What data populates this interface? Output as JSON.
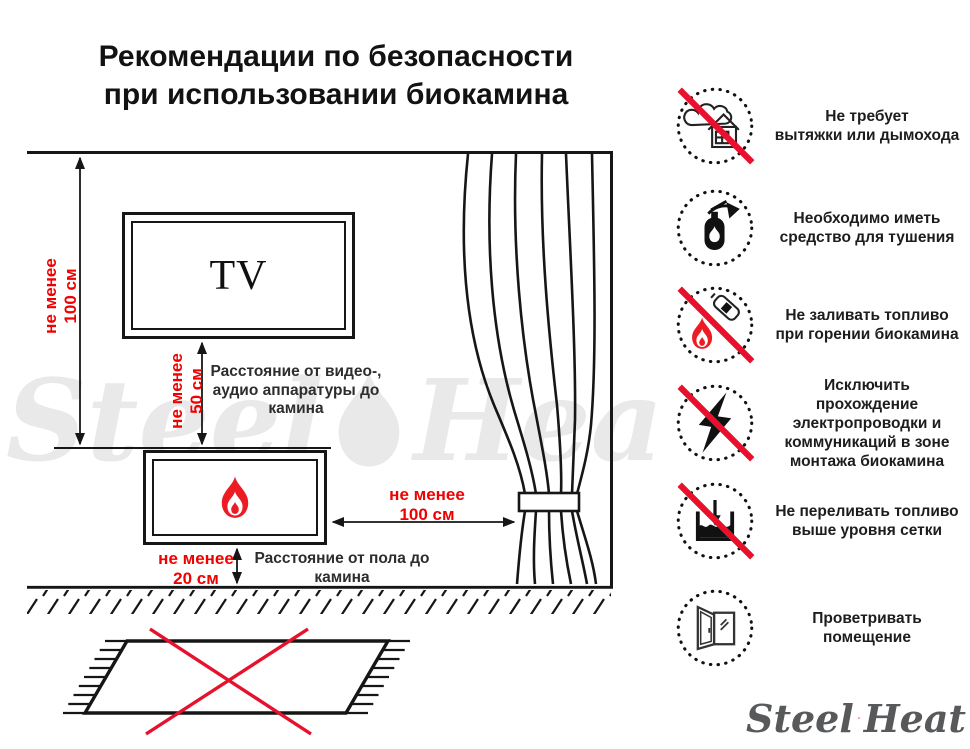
{
  "title": {
    "line1": "Рекомендации по безопасности",
    "line2": "при использовании биокамина"
  },
  "diagram": {
    "tv_label": "TV",
    "measurements": {
      "ceiling_to_fireplace": {
        "line1": "не менее",
        "line2": "100 см"
      },
      "tv_to_fireplace": {
        "line1": "не менее",
        "line2": "50 см",
        "caption": [
          "Расстояние от видео-,",
          "аудио аппаратуры до",
          "камина"
        ]
      },
      "fireplace_to_curtain": {
        "line1": "не менее",
        "line2": "100 см"
      },
      "fireplace_to_floor": {
        "line1": "не менее",
        "line2": "20 см",
        "caption": [
          "Расстояние от пола до",
          "камина"
        ]
      }
    }
  },
  "recommendations": [
    {
      "icon": "no-chimney-icon",
      "crossed": true,
      "lines": [
        "Не требует",
        "вытяжки или дымохода"
      ]
    },
    {
      "icon": "fire-extinguisher-icon",
      "crossed": false,
      "lines": [
        "Необходимо иметь",
        "средство для тушения"
      ]
    },
    {
      "icon": "no-refuel-burning-icon",
      "crossed": true,
      "lines": [
        "Не заливать топливо",
        "при горении биокамина"
      ]
    },
    {
      "icon": "no-wiring-icon",
      "crossed": true,
      "lines": [
        "Исключить прохождение",
        "электропроводки и",
        "коммуникаций в зоне",
        "монтажа биокамина"
      ]
    },
    {
      "icon": "no-overfill-icon",
      "crossed": true,
      "lines": [
        "Не переливать топливо",
        "выше уровня сетки"
      ]
    },
    {
      "icon": "ventilate-window-icon",
      "crossed": false,
      "lines": [
        "Проветривать",
        "помещение"
      ]
    }
  ],
  "watermark": {
    "word1": "Steel",
    "word2": "Heat"
  },
  "logo": {
    "word1": "Steel",
    "word2": "Heat"
  },
  "colors": {
    "measure_red": "#f10000",
    "cross_red": "#e8112d",
    "flame_red": "#ed1c24",
    "line_black": "#161616",
    "logo_gray": "#58595b",
    "watermark_gray": "#e9e9e9"
  }
}
